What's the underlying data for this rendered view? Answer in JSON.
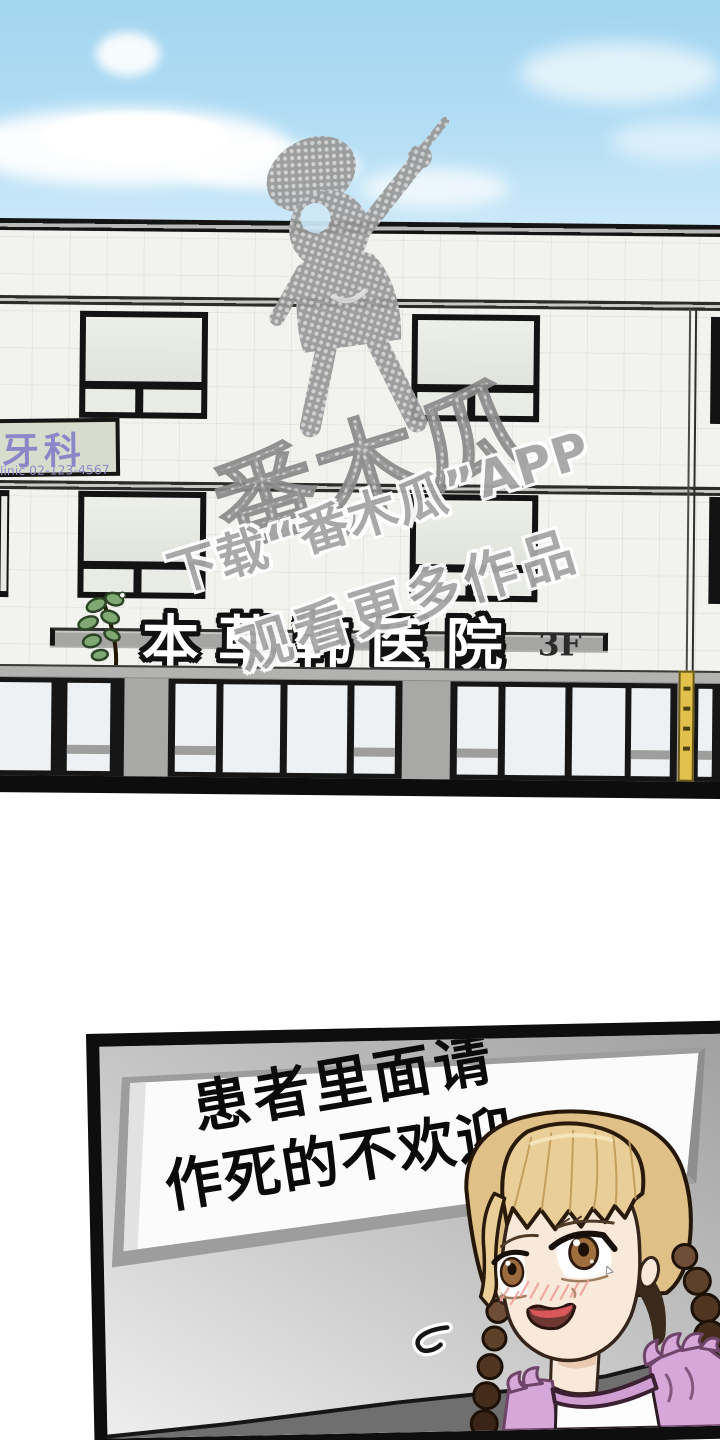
{
  "building": {
    "hospital_sign": {
      "name": "本草韩医院",
      "floor": "3F"
    },
    "dental_sign": {
      "title": "牙科",
      "subtitle": "clinic 02-123-4567"
    }
  },
  "watermark": {
    "logo": "番木瓜",
    "line1": "下载“番木瓜”APP",
    "line2": "观看更多作品"
  },
  "interior": {
    "sign_line1": "患者里面请",
    "sign_line2": "作死的不欢迎"
  },
  "colors": {
    "sky": "#aed9f1",
    "wall_tile": "#f2f2ef",
    "watermark_gray": "#9b9b9b",
    "dental_text_purple": "#8a86c8",
    "girl_hair": "#e6cb92",
    "girl_dress_pink": "#d6a8d9",
    "sign_white": "#fbfbfb"
  }
}
